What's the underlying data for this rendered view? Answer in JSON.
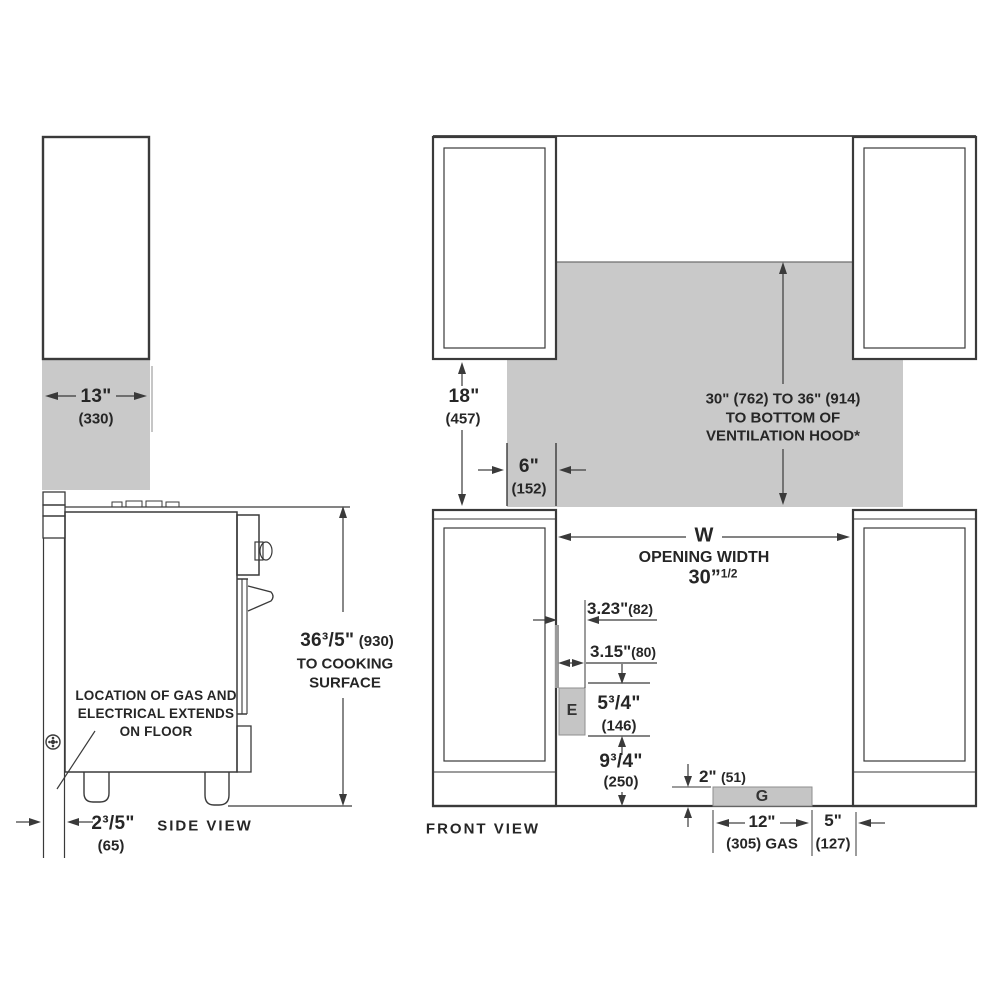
{
  "colors": {
    "clearance_gray": "#c9c9c9",
    "line": "#3a3a3a"
  },
  "side_view": {
    "view_label": "SIDE VIEW",
    "depth_13": {
      "in": "13\"",
      "mm": "(330)"
    },
    "height_36": {
      "in": "36³/5\"",
      "mm": "(930)",
      "note_line1": "TO COOKING",
      "note_line2": "SURFACE"
    },
    "back_2": {
      "in": "2³/5\"",
      "mm": "(65)"
    },
    "gas_note": {
      "line1": "LOCATION OF GAS AND",
      "line2": "ELECTRICAL EXTENDS",
      "line3": "ON FLOOR"
    }
  },
  "front_view": {
    "view_label": "FRONT VIEW",
    "hood_height_18": {
      "in": "18\"",
      "mm": "(457)"
    },
    "side_clearance_6": {
      "in": "6\"",
      "mm": "(152)"
    },
    "hood_clearance": {
      "line1": "30\" (762) TO 36\" (914)",
      "line2": "TO BOTTOM OF",
      "line3": "VENTILATION HOOD*"
    },
    "opening": {
      "symbol": "W",
      "label": "OPENING WIDTH",
      "value": "30”",
      "value_sup": "1/2"
    },
    "electrical_offset_323": {
      "in": "3.23\"",
      "mm": "(82)"
    },
    "electrical_offset_315": {
      "in": "3.15\"",
      "mm": "(80)"
    },
    "electrical_height_534": {
      "in": "5³/4\"",
      "mm": "(146)"
    },
    "electrical_floor_934": {
      "in": "9³/4\"",
      "mm": "(250)"
    },
    "gas_height_2": {
      "in": "2\"",
      "mm": "(51)"
    },
    "gas_width_12": {
      "in": "12\"",
      "mm": "(305) GAS"
    },
    "gas_offset_5": {
      "in": "5\"",
      "mm": "(127)"
    },
    "electrical_label": "E",
    "gas_label": "G"
  }
}
